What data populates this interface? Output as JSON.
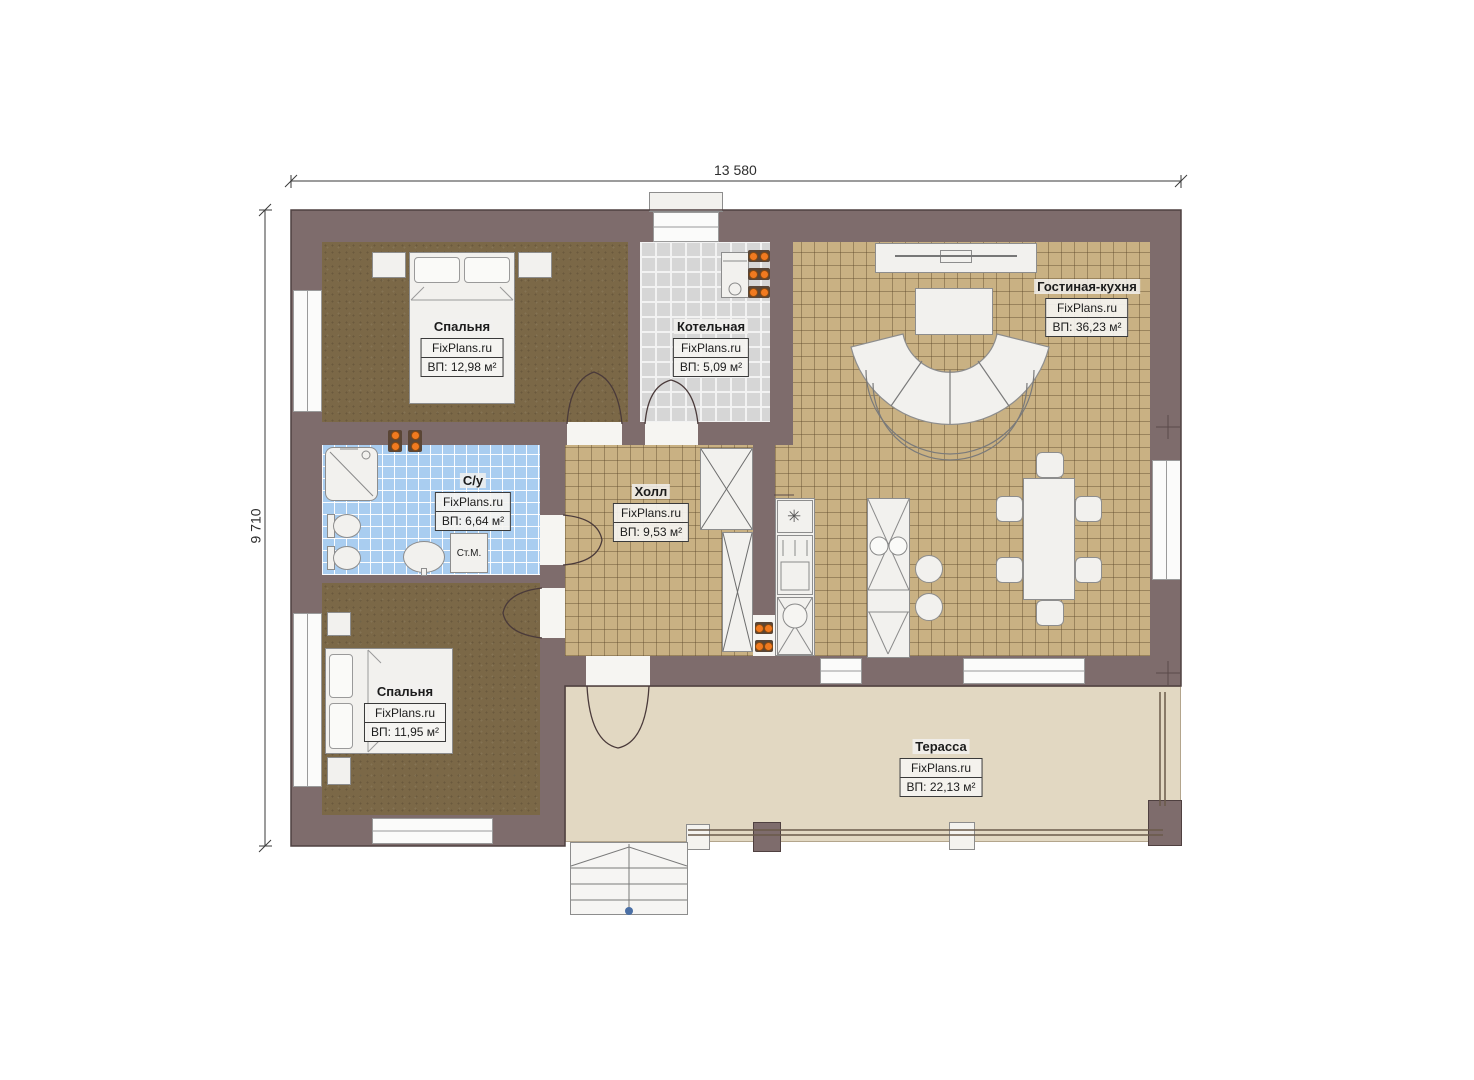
{
  "plan": {
    "brand": "FixPlans.ru",
    "dimensions": {
      "width_label": "13 580",
      "height_label": "9 710"
    },
    "rooms": [
      {
        "name": "Спальня",
        "brand": "FixPlans.ru",
        "area": "ВП: 12,98 м²"
      },
      {
        "name": "Котельная",
        "brand": "FixPlans.ru",
        "area": "ВП: 5,09 м²"
      },
      {
        "name": "Гостиная-кухня",
        "brand": "FixPlans.ru",
        "area": "ВП: 36,23 м²"
      },
      {
        "name": "С/у",
        "brand": "FixPlans.ru",
        "area": "ВП: 6,64 м²"
      },
      {
        "name": "Холл",
        "brand": "FixPlans.ru",
        "area": "ВП: 9,53 м²"
      },
      {
        "name": "Спальня",
        "brand": "FixPlans.ru",
        "area": "ВП: 11,95 м²"
      },
      {
        "name": "Терасса",
        "brand": "FixPlans.ru",
        "area": "ВП: 22,13 м²"
      }
    ],
    "labels": {
      "washing_machine": "Ст.М."
    },
    "colors": {
      "wall": "#7e6c6c",
      "radiator": "#f07a20",
      "tile_tan": "#c9b183",
      "tile_blue": "#a9cdf0",
      "tile_gray": "#d6d6d6",
      "terrace": "#e2d8c2"
    }
  }
}
